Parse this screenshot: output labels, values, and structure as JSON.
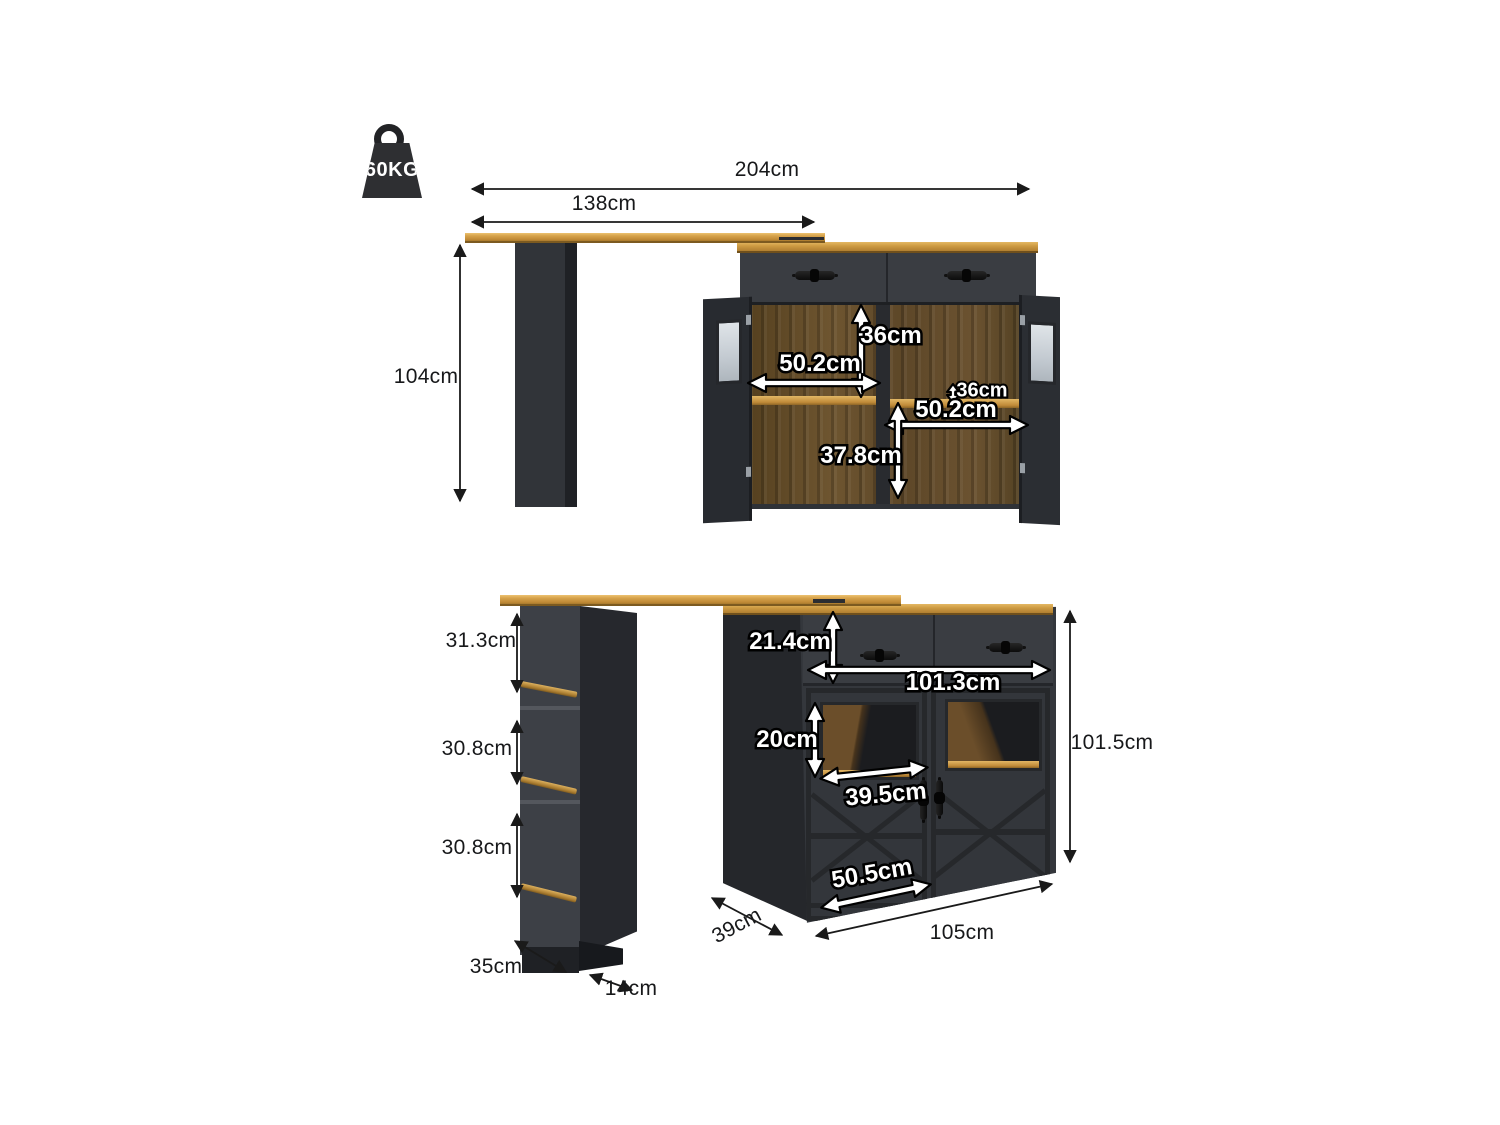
{
  "weight": {
    "label": "60KG"
  },
  "colors": {
    "wood": "#c9953f",
    "walnut": "#5d4728",
    "charcoal": "#34373c",
    "gold": "#b8893c",
    "dim_text": "#17181a",
    "dim_text_inner": "#ffffff"
  },
  "top_view": {
    "total_width": "204cm",
    "tabletop_width": "138cm",
    "height": "104cm",
    "left_section_height": "36cm",
    "left_section_width": "50.2cm",
    "right_section_height": "36cm",
    "right_section_width": "50.2cm",
    "bottom_section_height": "37.8cm"
  },
  "bottom_view": {
    "shelf_top_height": "31.3cm",
    "shelf_middle_height": "30.8cm",
    "shelf_bottom_height": "30.8cm",
    "column_depth": "35cm",
    "column_width": "14cm",
    "drawer_height": "21.4cm",
    "interior_width": "101.3cm",
    "window_height": "20cm",
    "window_width": "39.5cm",
    "door_width": "50.5cm",
    "cabinet_height": "101.5cm",
    "cabinet_depth": "39cm",
    "cabinet_width": "105cm"
  }
}
